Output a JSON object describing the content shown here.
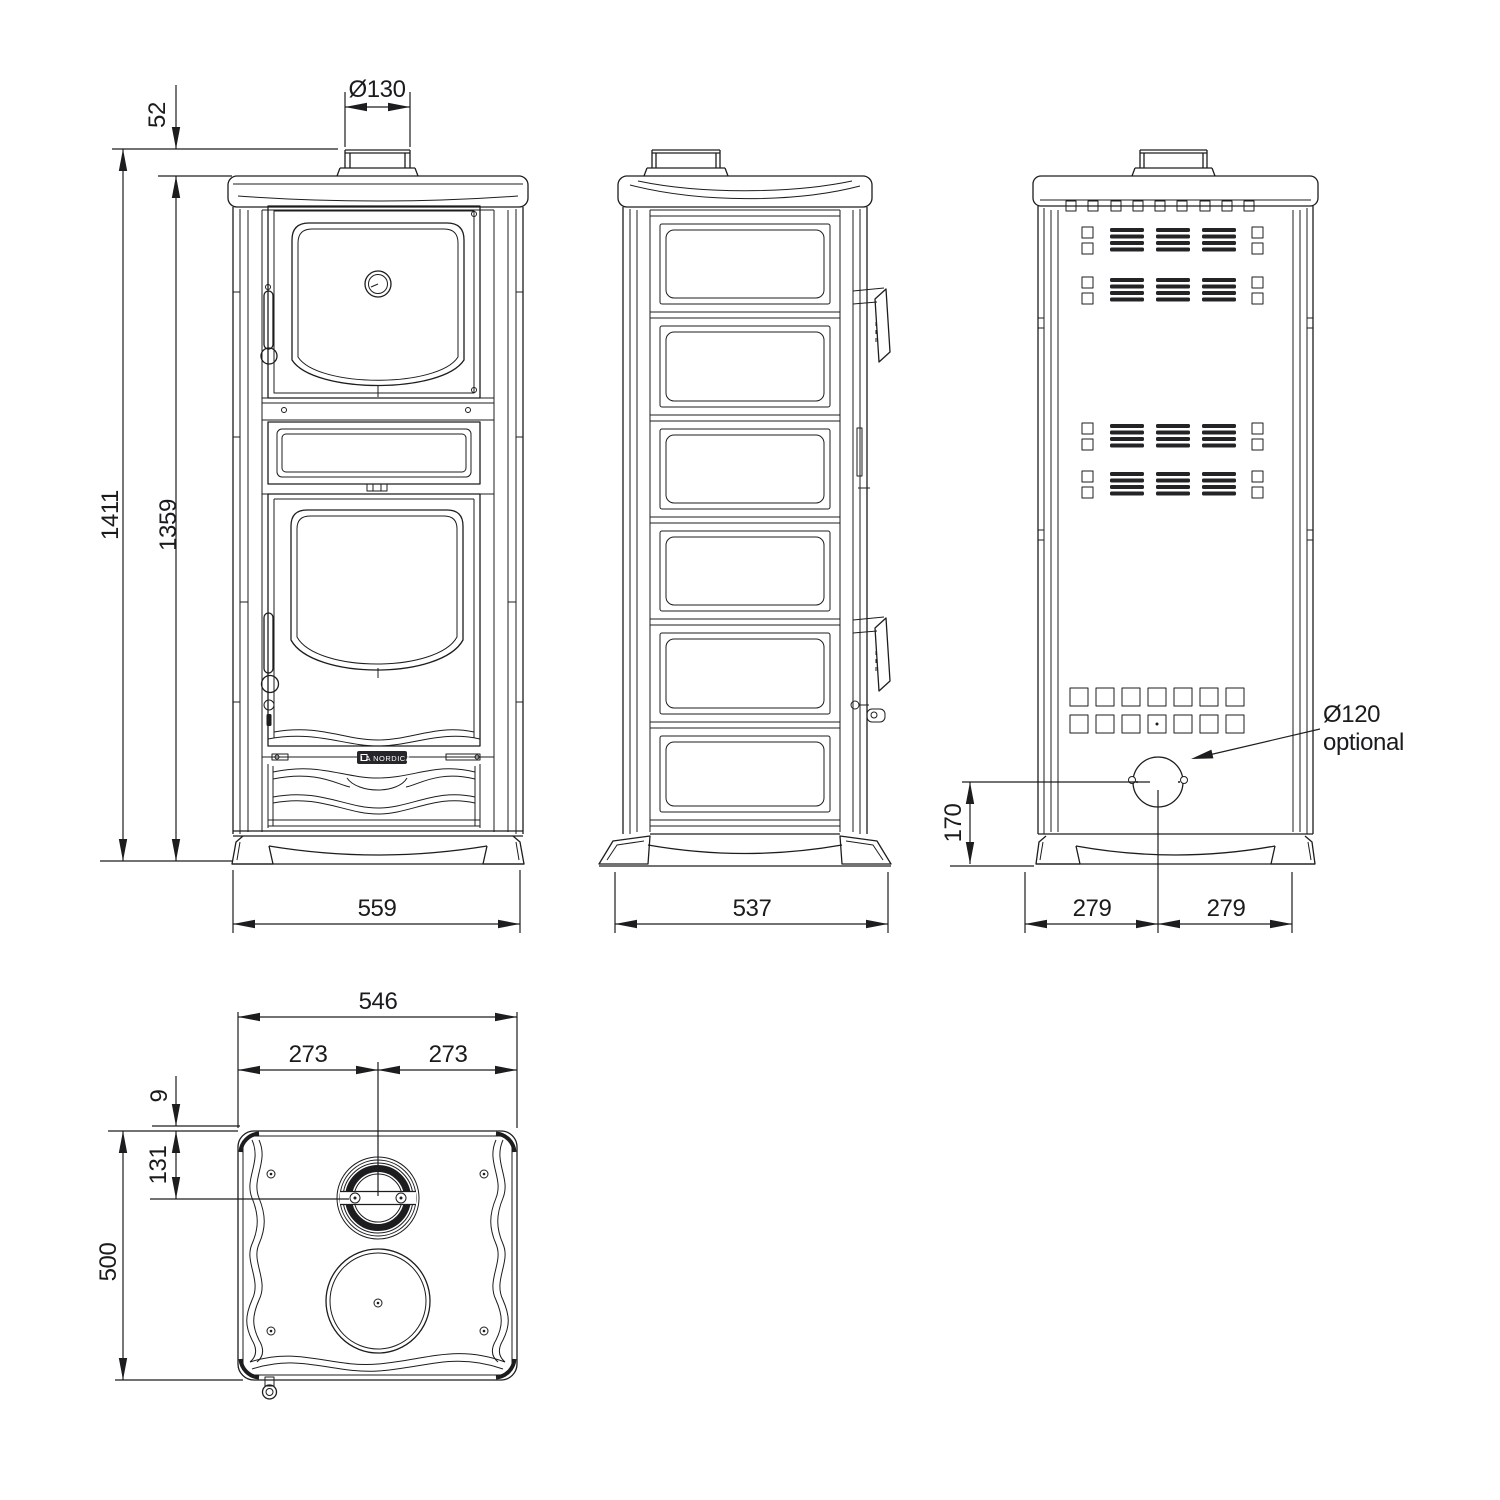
{
  "drawing_title": "Wood stove with oven - dimensional drawing",
  "dimensions": {
    "front": {
      "flue_diameter": "Ø130",
      "flue_collar_height": "52",
      "total_height": "1411",
      "body_height": "1359",
      "width": "559"
    },
    "side": {
      "depth": "537"
    },
    "rear": {
      "half_width_left": "279",
      "half_width_right": "279",
      "flue_axis_height": "170",
      "rear_flue_diameter": "Ø120",
      "rear_flue_note": "optional"
    },
    "top": {
      "width": "546",
      "half_width_left": "273",
      "half_width_right": "273",
      "rear_edge_offset": "9",
      "flue_axis_offset": "131",
      "depth": "500"
    }
  },
  "badge": {
    "label": "LA NORDICA"
  }
}
